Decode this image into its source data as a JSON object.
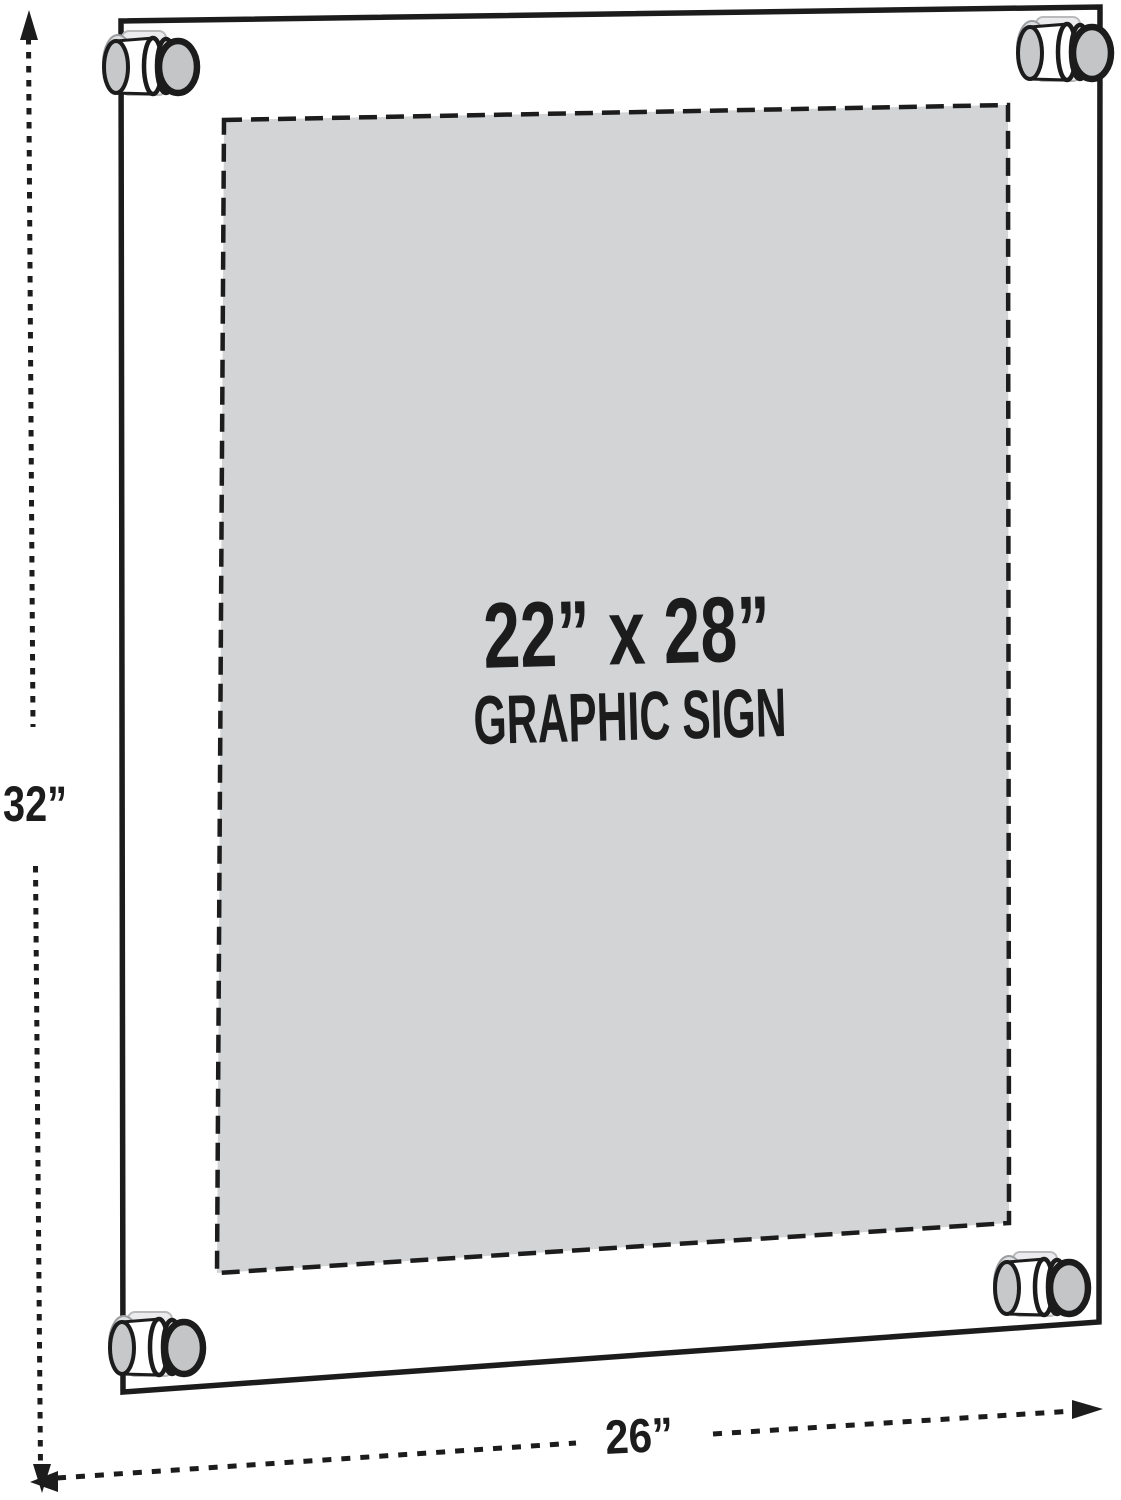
{
  "figure": {
    "type": "product-dimension-diagram",
    "product": "wall-mount acrylic sign holder with standoff hardware",
    "sign": {
      "size_label": "22” x 28”",
      "kind_label": "GRAPHIC SIGN"
    },
    "dimensions": {
      "height": "32”",
      "width": "26”"
    },
    "colors": {
      "line": "#1c1c1c",
      "panel_fill": "#d2d4d6",
      "hardware_cap_gray": "#c3c5c7",
      "hardware_light_gray": "#dcdedf",
      "background": "#ffffff"
    }
  }
}
